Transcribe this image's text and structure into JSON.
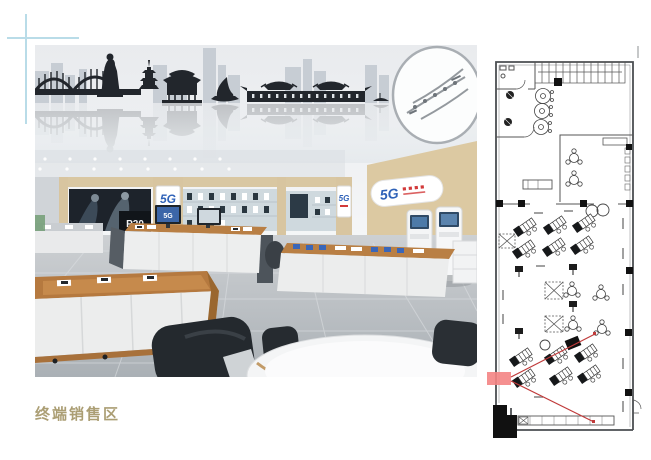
{
  "page": {
    "background": "#ffffff",
    "caption": "终端销售区"
  },
  "colors": {
    "caption": "#ab9e74",
    "crosshair": "#b9dce8",
    "right_rule": "#c6c8c9",
    "accent_blue": "#2f62b8",
    "accent_red": "#d23a3a",
    "wood": "#b5793f",
    "wall_beige": "#dcc9a2"
  },
  "render": {
    "logo_5g": "5G",
    "poster_model": "P20"
  },
  "floorplan": {
    "highlight_color": "#f48484",
    "leader_color": "#c03a3a"
  }
}
